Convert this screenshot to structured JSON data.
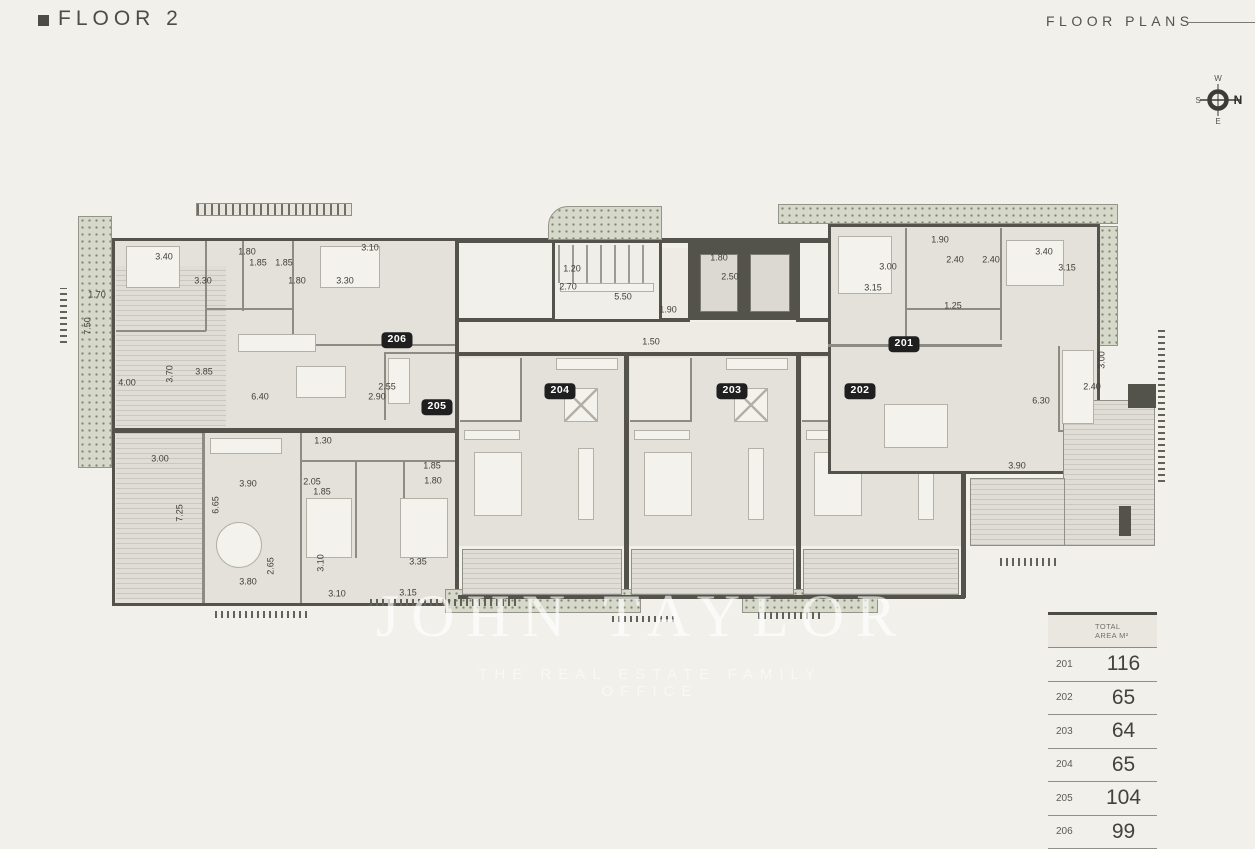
{
  "header": {
    "title": "FLOOR 2",
    "right_label": "FLOOR PLANS"
  },
  "compass": {
    "n": "N",
    "e": "E",
    "s": "S",
    "w": "W"
  },
  "watermark": {
    "name": "JOHN TAYLOR",
    "tagline": "THE REAL ESTATE FAMILY OFFICE"
  },
  "plan": {
    "lift_label": "LIFT",
    "badges": [
      {
        "id": "201",
        "x": 904,
        "y": 344
      },
      {
        "id": "202",
        "x": 860,
        "y": 391
      },
      {
        "id": "203",
        "x": 732,
        "y": 391
      },
      {
        "id": "204",
        "x": 560,
        "y": 391
      },
      {
        "id": "205",
        "x": 437,
        "y": 407
      },
      {
        "id": "206",
        "x": 397,
        "y": 340
      }
    ],
    "dimensions": [
      {
        "t": "3.40",
        "x": 164,
        "y": 257
      },
      {
        "t": "1.80",
        "x": 247,
        "y": 252
      },
      {
        "t": "1.85",
        "x": 258,
        "y": 263
      },
      {
        "t": "1.85",
        "x": 284,
        "y": 263
      },
      {
        "t": "3.30",
        "x": 203,
        "y": 281
      },
      {
        "t": "1.80",
        "x": 297,
        "y": 281
      },
      {
        "t": "3.30",
        "x": 345,
        "y": 281
      },
      {
        "t": "3.10",
        "x": 370,
        "y": 248
      },
      {
        "t": "1.70",
        "x": 97,
        "y": 295
      },
      {
        "t": "7.50",
        "x": 88,
        "y": 326,
        "v": true
      },
      {
        "t": "4.00",
        "x": 127,
        "y": 383
      },
      {
        "t": "3.70",
        "x": 170,
        "y": 374,
        "v": true
      },
      {
        "t": "3.85",
        "x": 204,
        "y": 372
      },
      {
        "t": "6.40",
        "x": 260,
        "y": 397
      },
      {
        "t": "2.55",
        "x": 387,
        "y": 387
      },
      {
        "t": "2.90",
        "x": 377,
        "y": 397
      },
      {
        "t": "3.00",
        "x": 160,
        "y": 459
      },
      {
        "t": "7.25",
        "x": 180,
        "y": 513,
        "v": true
      },
      {
        "t": "3.90",
        "x": 248,
        "y": 484
      },
      {
        "t": "6.65",
        "x": 216,
        "y": 505,
        "v": true
      },
      {
        "t": "1.30",
        "x": 323,
        "y": 441
      },
      {
        "t": "2.05",
        "x": 312,
        "y": 482
      },
      {
        "t": "1.85",
        "x": 322,
        "y": 492
      },
      {
        "t": "1.85",
        "x": 432,
        "y": 466
      },
      {
        "t": "1.80",
        "x": 433,
        "y": 481
      },
      {
        "t": "2.65",
        "x": 271,
        "y": 566,
        "v": true
      },
      {
        "t": "3.80",
        "x": 248,
        "y": 582
      },
      {
        "t": "3.10",
        "x": 321,
        "y": 563,
        "v": true
      },
      {
        "t": "3.10",
        "x": 337,
        "y": 594
      },
      {
        "t": "3.35",
        "x": 418,
        "y": 562
      },
      {
        "t": "3.15",
        "x": 408,
        "y": 593
      },
      {
        "t": "1.20",
        "x": 572,
        "y": 269
      },
      {
        "t": "2.70",
        "x": 568,
        "y": 287
      },
      {
        "t": "5.50",
        "x": 623,
        "y": 297
      },
      {
        "t": "1.90",
        "x": 668,
        "y": 310
      },
      {
        "t": "1.50",
        "x": 651,
        "y": 342
      },
      {
        "t": "1.80",
        "x": 719,
        "y": 258
      },
      {
        "t": "2.50",
        "x": 730,
        "y": 277
      },
      {
        "t": "1.90",
        "x": 940,
        "y": 240
      },
      {
        "t": "3.00",
        "x": 888,
        "y": 267
      },
      {
        "t": "3.15",
        "x": 873,
        "y": 288
      },
      {
        "t": "2.40",
        "x": 955,
        "y": 260
      },
      {
        "t": "2.40",
        "x": 991,
        "y": 260
      },
      {
        "t": "3.40",
        "x": 1044,
        "y": 252
      },
      {
        "t": "3.15",
        "x": 1067,
        "y": 268
      },
      {
        "t": "1.25",
        "x": 953,
        "y": 306
      },
      {
        "t": "3.00",
        "x": 1102,
        "y": 360,
        "v": true
      },
      {
        "t": "2.40",
        "x": 1092,
        "y": 387
      },
      {
        "t": "6.30",
        "x": 1041,
        "y": 401
      },
      {
        "t": "3.90",
        "x": 1017,
        "y": 466
      }
    ]
  },
  "area_table": {
    "header_line1": "TOTAL",
    "header_line2": "AREA M²",
    "rows": [
      {
        "unit": "201",
        "area": "116"
      },
      {
        "unit": "202",
        "area": "65"
      },
      {
        "unit": "203",
        "area": "64"
      },
      {
        "unit": "204",
        "area": "65"
      },
      {
        "unit": "205",
        "area": "104"
      },
      {
        "unit": "206",
        "area": "99"
      }
    ]
  }
}
